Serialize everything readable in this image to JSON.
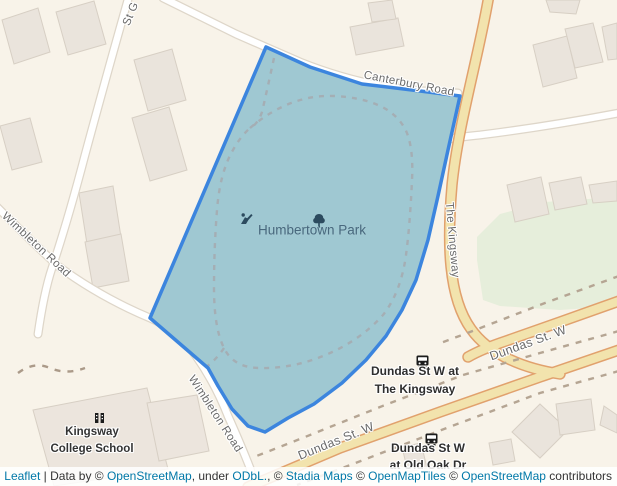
{
  "colors": {
    "background": "#f8f3e9",
    "overlay_stroke": "#3c85de",
    "overlay_fill": "#9fc8d2",
    "highway_fill": "#f2e3ad",
    "highway_casing": "#e1a16d",
    "road_fill": "#ffffff",
    "green_area": "#e6eedb",
    "building_fill": "#eae4dc",
    "attribution_link": "#0078a8"
  },
  "icons": {
    "park_tree": "tree-icon",
    "playground": "playground-icon",
    "bus_stop": "bus-icon",
    "school": "school-icon"
  },
  "labels": {
    "park": {
      "text": "Humbertown Park"
    },
    "canterbury": {
      "text": "Canterbury Road"
    },
    "kingsway": {
      "text": "The Kingsway"
    },
    "st_g": {
      "text": "St G"
    },
    "wimbleton_left": {
      "text": "Wimbleton Road"
    },
    "wimbleton_center": {
      "text": "Wimbleton Road"
    },
    "dundas_right": {
      "text": "Dundas St. W"
    },
    "dundas_bottom": {
      "text": "Dundas St. W"
    },
    "bus_stop_kingsway": {
      "line1": "Dundas St W at",
      "line2": "The Kingsway"
    },
    "bus_stop_old_oak": {
      "line1": "Dundas St W",
      "line2": "at Old Oak Dr"
    },
    "school": {
      "line1": "Kingsway",
      "line2": "College School"
    }
  },
  "attribution": {
    "segments": [
      {
        "text": "Leaflet",
        "link": true
      },
      {
        "text": " | Data by © ",
        "link": false
      },
      {
        "text": "OpenStreetMap",
        "link": true
      },
      {
        "text": ", under ",
        "link": false
      },
      {
        "text": "ODbL.",
        "link": true
      },
      {
        "text": ", © ",
        "link": false
      },
      {
        "text": "Stadia Maps",
        "link": true
      },
      {
        "text": " © ",
        "link": false
      },
      {
        "text": "OpenMapTiles",
        "link": true
      },
      {
        "text": " © ",
        "link": false
      },
      {
        "text": "OpenStreetMap",
        "link": true
      },
      {
        "text": " contributors",
        "link": false
      }
    ]
  }
}
